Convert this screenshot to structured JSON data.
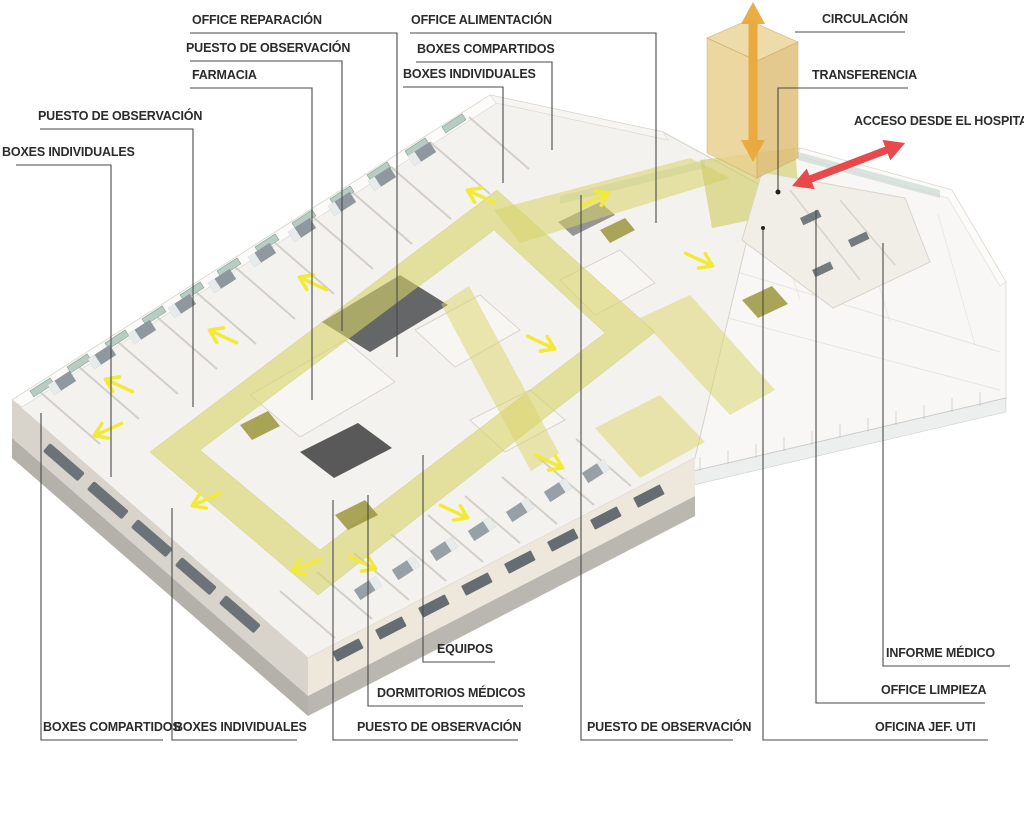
{
  "diagram": {
    "subject": "Axonometric hospital ICU floor plan diagram",
    "language": "es"
  },
  "labels": {
    "office_reparacion": "OFFICE REPARACIÓN",
    "puesto_observacion_top": "PUESTO DE OBSERVACIÓN",
    "farmacia": "FARMACIA",
    "office_alimentacion": "OFFICE ALIMENTACIÓN",
    "boxes_compartidos_top": "BOXES COMPARTIDOS",
    "boxes_individuales_top": "BOXES INDIVIDUALES",
    "circulacion": "CIRCULACIÓN",
    "transferencia": "TRANSFERENCIA",
    "acceso_desde_el_hospital": "ACCESO DESDE EL HOSPITAL",
    "puesto_observacion_left": "PUESTO DE OBSERVACIÓN",
    "boxes_individuales_left": "BOXES INDIVIDUALES",
    "boxes_compartidos_bottom": "BOXES COMPARTIDOS",
    "boxes_individuales_bottom": "BOXES INDIVIDUALES",
    "puesto_observacion_bottom_left": "PUESTO DE OBSERVACIÓN",
    "dormitorios_medicos": "DORMITORIOS MÉDICOS",
    "equipos": "EQUIPOS",
    "puesto_observacion_bottom_right": "PUESTO DE OBSERVACIÓN",
    "oficina_jef_uti": "OFICINA JEF. UTI",
    "office_limpieza": "OFFICE LIMPIEZA",
    "informe_medico": "INFORME MÉDICO"
  },
  "colors": {
    "corridor_highlight": "#d9d468",
    "flow_arrow_yellow": "#f2ea37",
    "circulation_tower_orange": "#e9d190",
    "circulation_arrow_orange": "#e9a93c",
    "access_arrow_red": "#e8494d",
    "leader_line": "#4a4a4a",
    "label_text": "#2b2b2b"
  }
}
